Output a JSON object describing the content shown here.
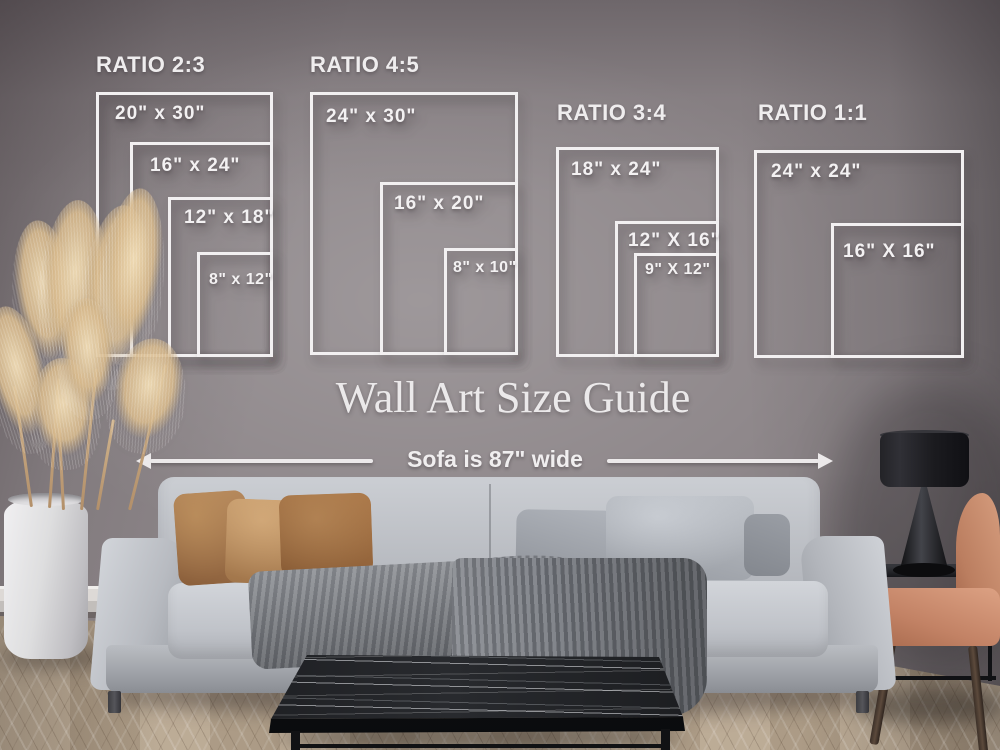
{
  "title": "Wall Art Size Guide",
  "sofa_width": {
    "label": "Sofa is 87\" wide"
  },
  "guide": {
    "overlay_color": "#f2f0f1",
    "groups": [
      {
        "name": "RATIO 2:3",
        "header": {
          "x": 96,
          "y": 52
        },
        "sizes": [
          {
            "label": "20\" x 30\"",
            "x": 96,
            "y": 92,
            "w": 177,
            "h": 265,
            "lx": 16,
            "ly": 8
          },
          {
            "label": "16\" x 24\"",
            "x": 130,
            "y": 142,
            "w": 143,
            "h": 215,
            "lx": 17,
            "ly": 10
          },
          {
            "label": "12\" x 18\"",
            "x": 168,
            "y": 197,
            "w": 105,
            "h": 160,
            "lx": 13,
            "ly": 7
          },
          {
            "label": "8\" x 12\"",
            "x": 197,
            "y": 252,
            "w": 76,
            "h": 105,
            "lx": 9,
            "ly": 16
          }
        ]
      },
      {
        "name": "RATIO 4:5",
        "header": {
          "x": 310,
          "y": 52
        },
        "sizes": [
          {
            "label": "24\" x 30\"",
            "x": 310,
            "y": 92,
            "w": 208,
            "h": 263,
            "lx": 13,
            "ly": 11
          },
          {
            "label": "16\" x 20\"",
            "x": 380,
            "y": 182,
            "w": 138,
            "h": 173,
            "lx": 11,
            "ly": 8
          },
          {
            "label": "8\" x 10\"",
            "x": 444,
            "y": 248,
            "w": 74,
            "h": 107,
            "lx": 6,
            "ly": 8
          }
        ]
      },
      {
        "name": "RATIO 3:4",
        "header": {
          "x": 557,
          "y": 100
        },
        "sizes": [
          {
            "label": "18\" x 24\"",
            "x": 556,
            "y": 147,
            "w": 163,
            "h": 210,
            "lx": 12,
            "ly": 9
          },
          {
            "label": "12\" X 16\"",
            "x": 615,
            "y": 221,
            "w": 104,
            "h": 136,
            "lx": 10,
            "ly": 6
          },
          {
            "label": "9\" X 12\"",
            "x": 634,
            "y": 253,
            "w": 85,
            "h": 104,
            "lx": 8,
            "ly": 5
          }
        ]
      },
      {
        "name": "RATIO 1:1",
        "header": {
          "x": 758,
          "y": 100
        },
        "sizes": [
          {
            "label": "24\" x 24\"",
            "x": 754,
            "y": 150,
            "w": 210,
            "h": 208,
            "lx": 14,
            "ly": 8
          },
          {
            "label": "16\" X 16\"",
            "x": 831,
            "y": 223,
            "w": 133,
            "h": 135,
            "lx": 9,
            "ly": 15
          }
        ]
      }
    ]
  },
  "colors": {
    "wall": "#8d8689",
    "floor_wood": "#b7a690",
    "sofa_fabric": "#c2c5ca",
    "pillow_leather_brown": "#a87a50",
    "pillow_gray": "#a9adb4",
    "throw_blanket_gray": "#797c82",
    "coffee_table_marble": "#1a1b1e",
    "table_lamp_black": "#1a1a1e",
    "armchair_terracotta": "#c88c6e",
    "vase_white": "#e6e4e6",
    "pampas_beige": "#d6bb92"
  }
}
